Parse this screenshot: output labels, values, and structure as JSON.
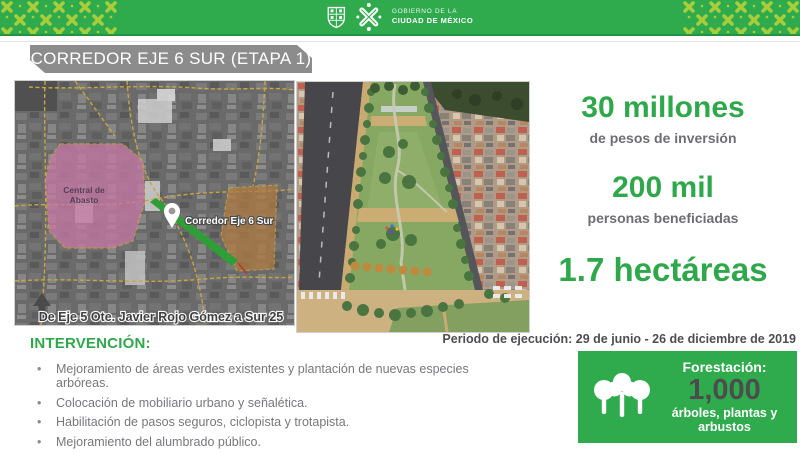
{
  "header": {
    "agency_line1": "GOBIERNO DE LA",
    "agency_line2": "CIUDAD DE MÉXICO"
  },
  "title": "CORREDOR EJE 6 SUR (ETAPA 1)",
  "map": {
    "area_label_line1": "Central de",
    "area_label_line2": "Abasto",
    "corridor_label": "Corredor Eje 6 Sur",
    "caption": "De Eje 5 Ote. Javier Rojo Gómez a Sur 25"
  },
  "stats": [
    {
      "value": "30 millones",
      "label": "de pesos de inversión"
    },
    {
      "value": "200 mil",
      "label": "personas beneficiadas"
    },
    {
      "value": "1.7 hectáreas",
      "label": ""
    }
  ],
  "periodo": "Periodo de ejecución: 29 de junio - 26 de diciembre de 2019",
  "intervencion": {
    "heading": "INTERVENCIÓN:",
    "items": [
      "Mejoramiento de áreas verdes existentes y plantación de nuevas especies arbóreas.",
      "Colocación de mobiliario urbano y señalética.",
      "Habilitación de pasos seguros, ciclopista y trotapista.",
      "Mejoramiento del alumbrado público."
    ]
  },
  "forestacion": {
    "heading": "Forestación:",
    "value": "1,000",
    "label": "árboles, plantas y arbustos"
  },
  "colors": {
    "brand_green": "#2fab4d",
    "pattern_green": "#a7cd3b",
    "banner_gray": "#8c8c8c",
    "stat_green": "#2fa84c",
    "label_gray": "#6d6e71",
    "body_gray": "#77787b",
    "dark_gray": "#4d4e50",
    "map_pink": "#c478a4",
    "map_tan": "#b07a42",
    "corridor_green": "#2f9e37"
  }
}
